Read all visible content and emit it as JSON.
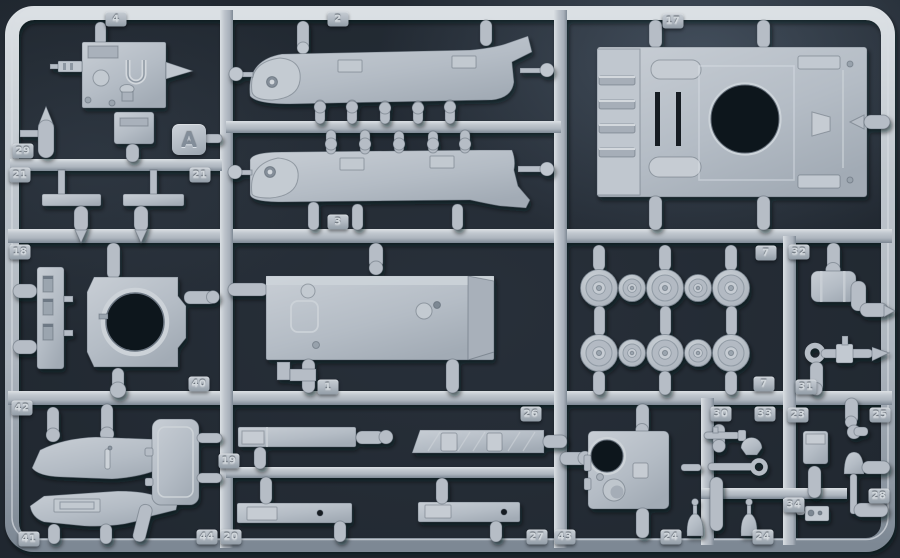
{
  "scene": {
    "type": "photograph",
    "subject": "Light grey injection-molded plastic model kit sprue with numbered tank parts on dark background",
    "sprue_letter": "A"
  },
  "colors": {
    "background": "#232b34",
    "plastic": "#b6bdc6",
    "plastic_highlight": "#d8dde2",
    "plastic_shadow": "#7e8994",
    "hole_dark": "#11161c",
    "tag_text": "#d2d8dd"
  },
  "letter_plate": {
    "label": "A"
  },
  "tags": [
    {
      "label": "4",
      "x": 116,
      "y": 19
    },
    {
      "label": "2",
      "x": 338,
      "y": 19
    },
    {
      "label": "17",
      "x": 673,
      "y": 21
    },
    {
      "label": "29",
      "x": 23,
      "y": 151
    },
    {
      "label": "21",
      "x": 20,
      "y": 175
    },
    {
      "label": "21",
      "x": 200,
      "y": 175
    },
    {
      "label": "3",
      "x": 338,
      "y": 222
    },
    {
      "label": "18",
      "x": 20,
      "y": 252
    },
    {
      "label": "7",
      "x": 766,
      "y": 253
    },
    {
      "label": "32",
      "x": 799,
      "y": 252
    },
    {
      "label": "40",
      "x": 199,
      "y": 384
    },
    {
      "label": "1",
      "x": 328,
      "y": 387
    },
    {
      "label": "7",
      "x": 764,
      "y": 384
    },
    {
      "label": "31",
      "x": 806,
      "y": 387
    },
    {
      "label": "42",
      "x": 22,
      "y": 408
    },
    {
      "label": "26",
      "x": 531,
      "y": 414
    },
    {
      "label": "30",
      "x": 721,
      "y": 414
    },
    {
      "label": "33",
      "x": 765,
      "y": 414
    },
    {
      "label": "23",
      "x": 798,
      "y": 415
    },
    {
      "label": "25",
      "x": 880,
      "y": 415
    },
    {
      "label": "19",
      "x": 229,
      "y": 461
    },
    {
      "label": "34",
      "x": 794,
      "y": 505
    },
    {
      "label": "28",
      "x": 879,
      "y": 496
    },
    {
      "label": "41",
      "x": 29,
      "y": 539
    },
    {
      "label": "44",
      "x": 207,
      "y": 537
    },
    {
      "label": "20",
      "x": 231,
      "y": 537
    },
    {
      "label": "27",
      "x": 537,
      "y": 537
    },
    {
      "label": "43",
      "x": 565,
      "y": 537
    },
    {
      "label": "24",
      "x": 671,
      "y": 537
    },
    {
      "label": "24",
      "x": 763,
      "y": 537
    }
  ],
  "part_numbers_visible": [
    "1",
    "2",
    "3",
    "4",
    "7",
    "17",
    "18",
    "19",
    "20",
    "21",
    "23",
    "24",
    "25",
    "26",
    "27",
    "28",
    "29",
    "30",
    "31",
    "32",
    "33",
    "34",
    "40",
    "41",
    "42",
    "43",
    "44"
  ]
}
